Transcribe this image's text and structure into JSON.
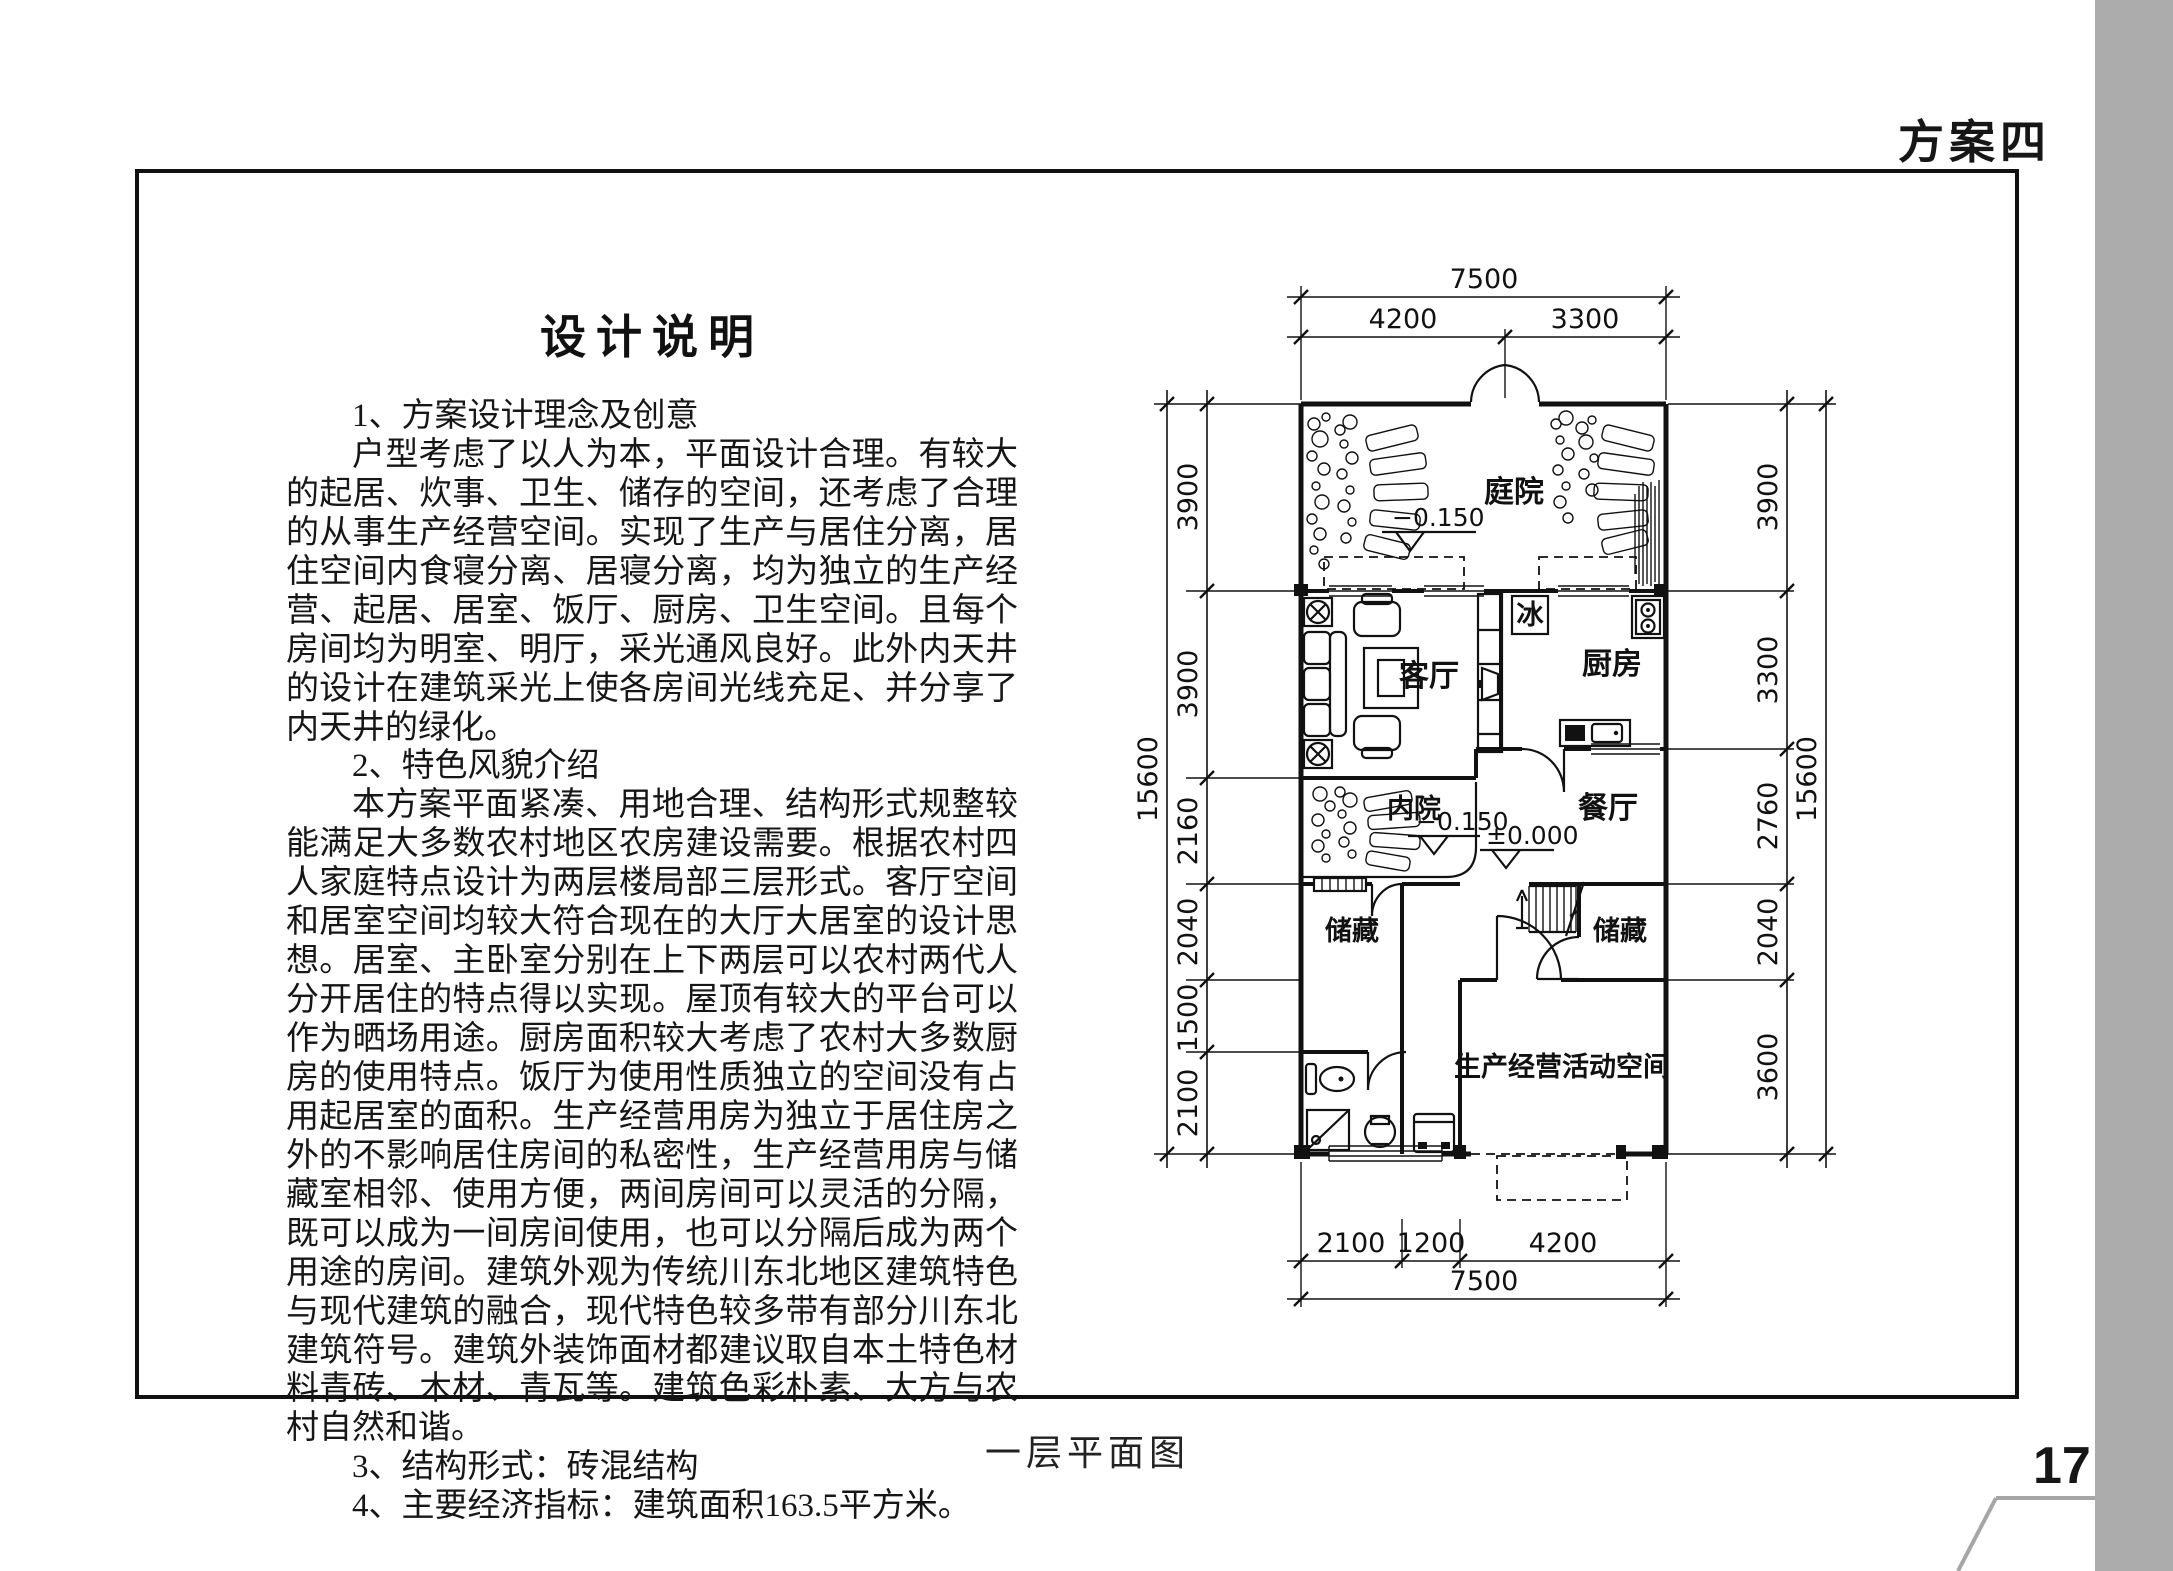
{
  "page": {
    "tag": "方案四",
    "page_number": "17",
    "caption": "一层平面图"
  },
  "article": {
    "title": "设计说明",
    "paragraphs": [
      "1、方案设计理念及创意",
      "户型考虑了以人为本，平面设计合理。有较大的起居、炊事、卫生、储存的空间，还考虑了合理的从事生产经营空间。实现了生产与居住分离，居住空间内食寝分离、居寝分离，均为独立的生产经营、起居、居室、饭厅、厨房、卫生空间。且每个房间均为明室、明厅，采光通风良好。此外内天井的设计在建筑采光上使各房间光线充足、并分享了内天井的绿化。",
      "2、特色风貌介绍",
      "本方案平面紧凑、用地合理、结构形式规整较能满足大多数农村地区农房建设需要。根据农村四人家庭特点设计为两层楼局部三层形式。客厅空间和居室空间均较大符合现在的大厅大居室的设计思想。居室、主卧室分别在上下两层可以农村两代人分开居住的特点得以实现。屋顶有较大的平台可以作为晒场用途。厨房面积较大考虑了农村大多数厨房的使用特点。饭厅为使用性质独立的空间没有占用起居室的面积。生产经营用房为独立于居住房之外的不影响居住房间的私密性，生产经营用房与储藏室相邻、使用方便，两间房间可以灵活的分隔，既可以成为一间房间使用，也可以分隔后成为两个用途的房间。建筑外观为传统川东北地区建筑特色与现代建筑的融合，现代特色较多带有部分川东北建筑符号。建筑外装饰面材都建议取自本土特色材料青砖、木材、青瓦等。建筑色彩朴素、大方与农村自然和谐。",
      "3、结构形式：砖混结构",
      "4、主要经济指标：建筑面积163.5平方米。"
    ]
  },
  "plan": {
    "rooms": {
      "courtyard": "庭院",
      "living_room": "客厅",
      "fridge": "冰",
      "kitchen": "厨房",
      "inner_courtyard": "内院",
      "dining_room": "餐厅",
      "storage_left": "储藏",
      "storage_right": "储藏",
      "production_space": "生产经营活动空间"
    },
    "levels": {
      "courtyard": "−0.150",
      "inner_courtyard": "−0.150",
      "ground": "±0.000"
    },
    "dims": {
      "top_total": "7500",
      "top_segments": [
        "4200",
        "3300"
      ],
      "left_total": "15600",
      "left_segments": [
        "3900",
        "3900",
        "2160",
        "2040",
        "1500",
        "2100"
      ],
      "right_total": "15600",
      "right_segments": [
        "3900",
        "3300",
        "2760",
        "2040",
        "3600"
      ],
      "bottom_total": "7500",
      "bottom_segments": [
        "2100",
        "1200",
        "4200"
      ]
    }
  },
  "colors": {
    "edge_band": "#acacac",
    "footer_line": "#a6a6a6",
    "ink": "#111111"
  }
}
